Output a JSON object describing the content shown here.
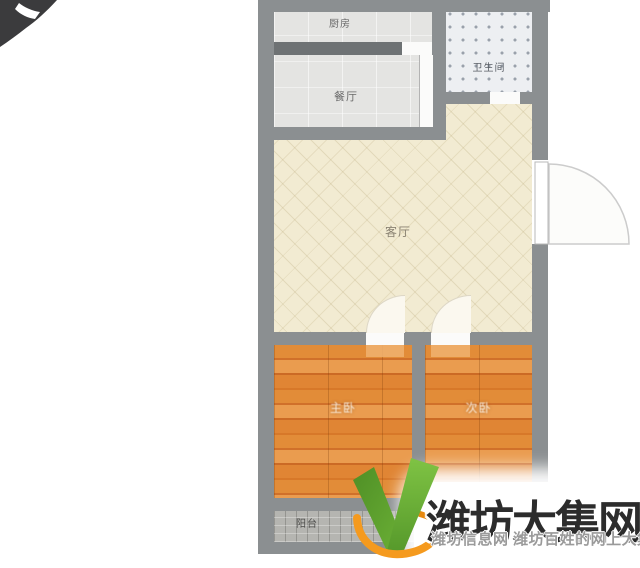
{
  "floorplan": {
    "rooms": {
      "kitchen": {
        "label": "厨房"
      },
      "dining": {
        "label": "餐厅"
      },
      "bathroom": {
        "label": "卫生间"
      },
      "living": {
        "label": "客厅"
      },
      "bedroom_main": {
        "label": "主卧"
      },
      "bedroom_second": {
        "label": "次卧"
      },
      "balcony": {
        "label": "阳台"
      }
    },
    "colors": {
      "wall": "#8b8f91",
      "living_floor": "#f2ebd2",
      "bedroom_floor": "#df8433",
      "kitchen_floor": "#e4e4e2",
      "bathroom_floor": "#edeff2",
      "balcony_floor": "#b5b5b1"
    }
  },
  "watermark": {
    "title": "潍坊大集网",
    "subtitle": "潍坊信息网 潍坊百姓的网上大集",
    "logo_green": "#66ab33",
    "logo_orange": "#f59a1e",
    "title_color": "#2c2c2c",
    "subtitle_color": "#9a9a9a"
  }
}
